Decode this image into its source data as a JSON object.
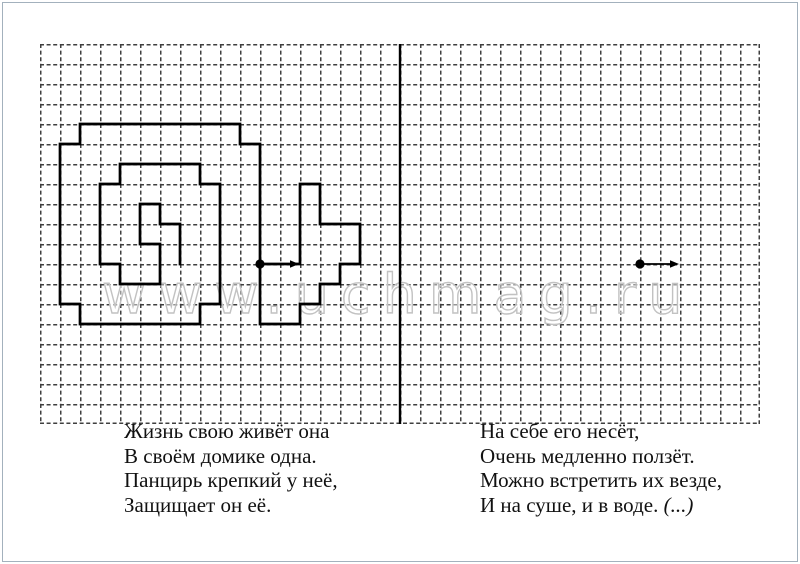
{
  "worksheet": {
    "kind": "graphic-dictation grid worksheet",
    "watermark": "www.uchmag.ru"
  },
  "drawing": {
    "figure_name": "snail outline drawn on grid",
    "path_d": "M260 264 H300 V184 H320 V224 H360 V264 H340 V284 H320 V304 H300 V324 H260 V144 H240 V124 H80 V144 H60 V304 H80 V324 H200 V304 H220 V184 H200 V164 H120 V184 H100 V264 H120 V284 H160 V244 H140 V204 H160 V224 H180 V264",
    "stroke": "#000000",
    "start_points": [
      {
        "x": 260,
        "y": 264,
        "arrow": {
          "x1": 260,
          "y1": 264,
          "x2": 290,
          "y2": 264,
          "head": "290,260.2 290,267.8 299,264"
        }
      },
      {
        "x": 640,
        "y": 264,
        "arrow": {
          "x1": 640,
          "y1": 264,
          "x2": 670,
          "y2": 264,
          "head": "670,260.2 670,267.8 679,264"
        }
      }
    ]
  },
  "riddles": {
    "left": {
      "lines": [
        "Жизнь свою живёт она",
        "В своём домике одна.",
        "Панцирь крепкий у неё,",
        "Защищает он её."
      ]
    },
    "right": {
      "lines": [
        "На себе его несёт,",
        "Очень медленно ползёт.",
        "Можно встретить их везде,",
        "И на суше, и в воде."
      ],
      "answer_hint": "(...)"
    }
  }
}
